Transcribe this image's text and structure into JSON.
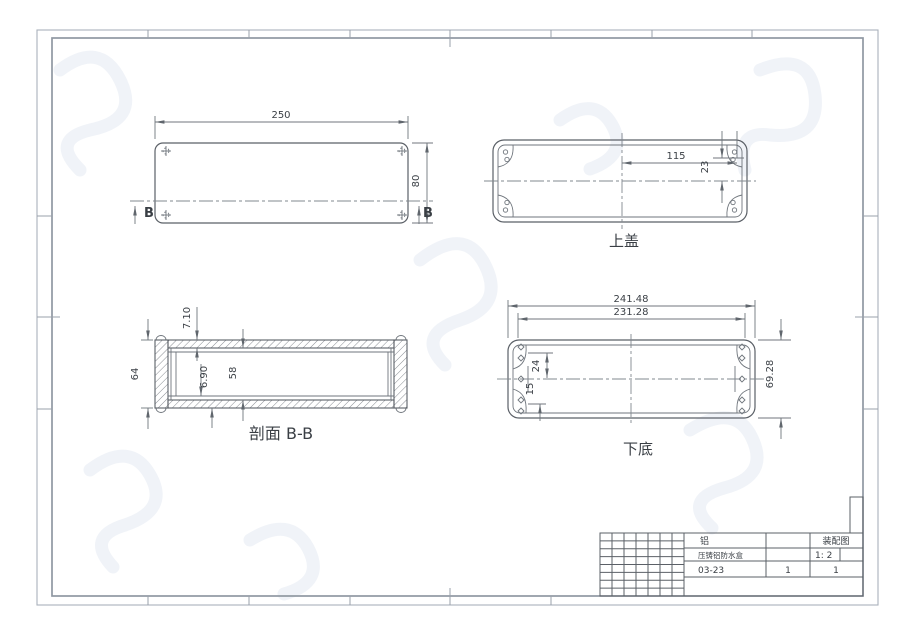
{
  "colors": {
    "drawing_line": "#5b6067",
    "dimension_line": "#70767d",
    "frame_line": "#9098a2",
    "text": "#3a3f45",
    "background": "#ffffff"
  },
  "views": {
    "plan": {
      "dim_width": "250",
      "dim_height": "80",
      "section_label_left": "B",
      "section_label_right": "B"
    },
    "top_cover": {
      "title": "上盖",
      "dim_offset_x": "115",
      "dim_offset_y": "23"
    },
    "section_bb": {
      "title": "剖面 B-B",
      "dim_overall_height": "64",
      "dim_top_wall": "7.10",
      "dim_bottom_wall": "6.90",
      "dim_inner_height": "58"
    },
    "bottom_base": {
      "title": "下底",
      "dim_outer_width": "241.48",
      "dim_inner_width": "231.28",
      "dim_overall_height": "69.28",
      "dim_hole_offset_top": "24",
      "dim_hole_offset_bottom": "15"
    }
  },
  "title_block": {
    "material": "铝",
    "doc_type": "装配图",
    "part_name": "压铸铝防水盒",
    "scale": "1: 2",
    "drawing_no": "03-23",
    "sheet_no": "1",
    "sheet_total": "1"
  }
}
